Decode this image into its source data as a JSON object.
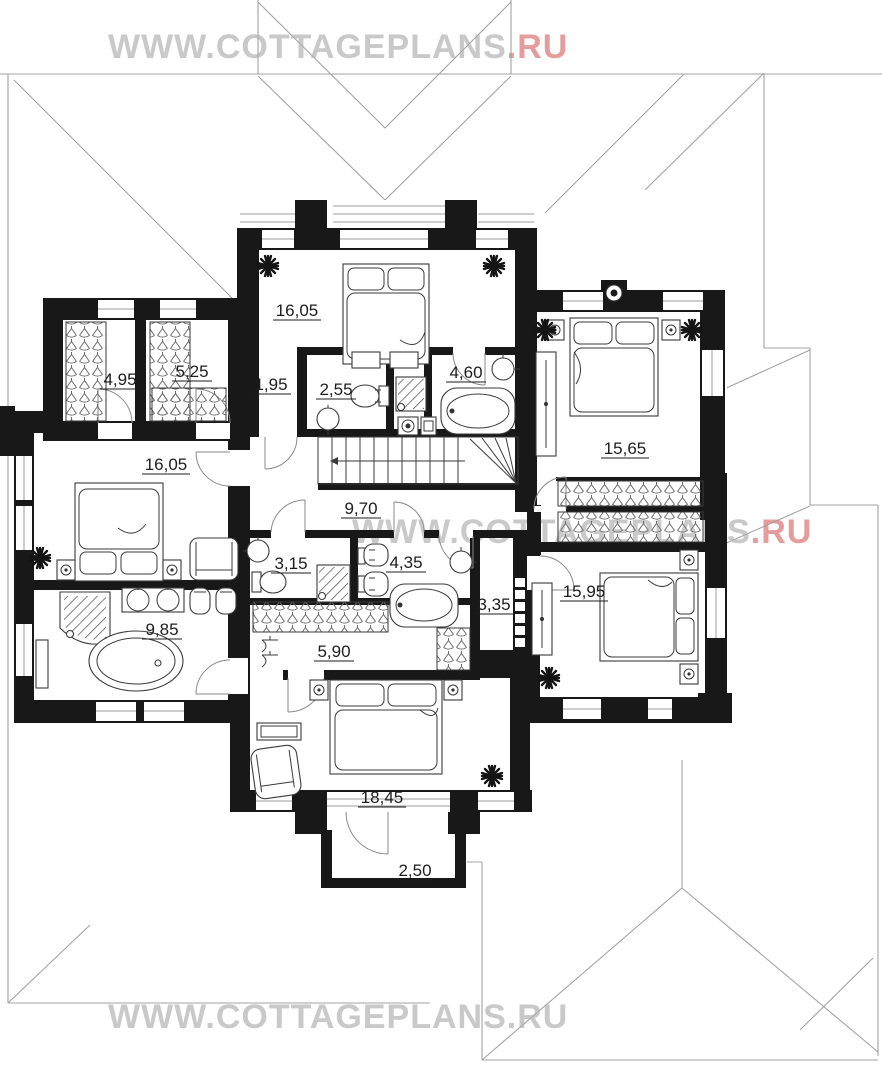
{
  "watermarks": {
    "top": {
      "prefix": "WWW.COTTAGEPLANS",
      "suffix": ".RU"
    },
    "middle": {
      "prefix": "WWW.COTTAGEPLANS",
      "suffix": ".RU"
    },
    "bottom": {
      "prefix": "WWW.COTTAGEPLANS",
      "suffix": ".RU"
    }
  },
  "colors": {
    "wall": "#181818",
    "watermark_gray": "#c9c9c9",
    "watermark_red": "#e59c9c",
    "roof_line": "#a3a3a3",
    "label_text": "#1d1d1d"
  },
  "plan": {
    "type": "architectural-floor-plan",
    "floor": "second floor cottage plan",
    "rooms": [
      {
        "id": "bedroom-top",
        "area": "16,05"
      },
      {
        "id": "wardrobe-a",
        "area": "4,95"
      },
      {
        "id": "wardrobe-b",
        "area": "5,25"
      },
      {
        "id": "hall-a",
        "area": "1,95"
      },
      {
        "id": "wc-a",
        "area": "2,55"
      },
      {
        "id": "bathroom-a",
        "area": "4,60"
      },
      {
        "id": "bedroom-right",
        "area": "15,65"
      },
      {
        "id": "bedroom-left",
        "area": "16,05"
      },
      {
        "id": "corridor",
        "area": "9,70"
      },
      {
        "id": "wc-b",
        "area": "3,15"
      },
      {
        "id": "bathroom-b",
        "area": "4,35"
      },
      {
        "id": "hall-b",
        "area": "3,35"
      },
      {
        "id": "bathroom-c",
        "area": "9,85"
      },
      {
        "id": "closet",
        "area": "5,90"
      },
      {
        "id": "bedroom-se",
        "area": "15,95"
      },
      {
        "id": "bedroom-south",
        "area": "18,45"
      },
      {
        "id": "balcony",
        "area": "2,50"
      }
    ]
  }
}
